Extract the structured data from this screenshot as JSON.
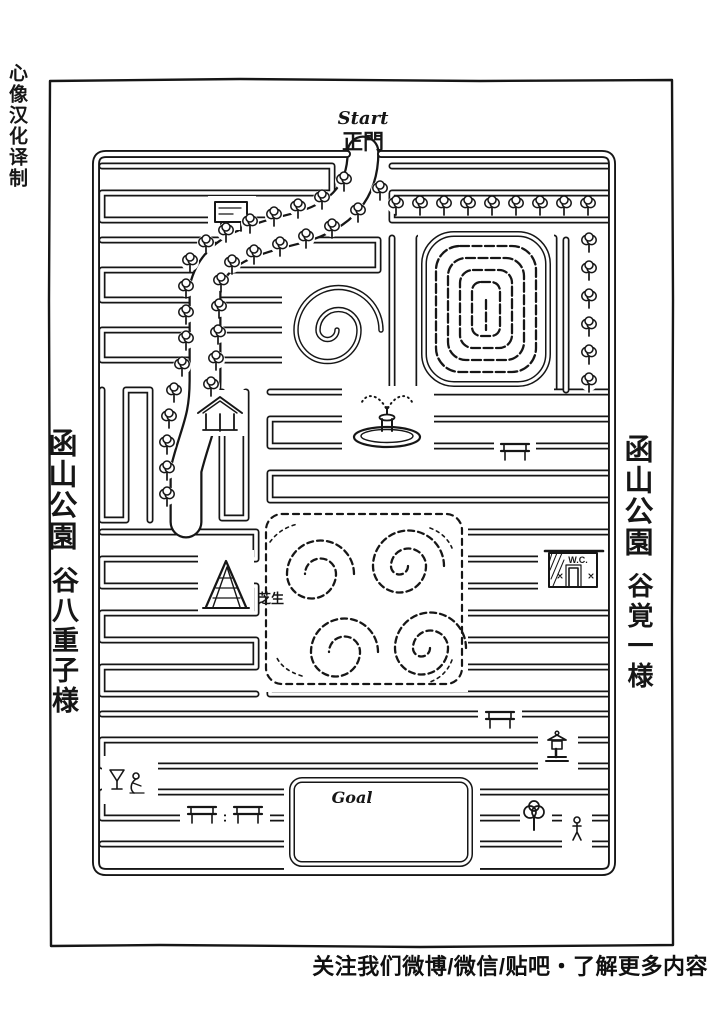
{
  "page": {
    "background": "#ffffff",
    "ink": "#161616",
    "logo_vertical": "心像汉化译制",
    "credits_line": "关注我们微博/微信/贴吧・了解更多内容"
  },
  "map": {
    "start_label": "Start",
    "gate_label": "正門",
    "goal_label": "Goal",
    "wc_label": "W.C.",
    "lawn_label": "芝生",
    "left_margin": {
      "park_name": "函山公園",
      "addressee": "谷八重子様"
    },
    "right_margin": {
      "park_name": "函山公園",
      "addressee": "谷覚一様"
    }
  }
}
